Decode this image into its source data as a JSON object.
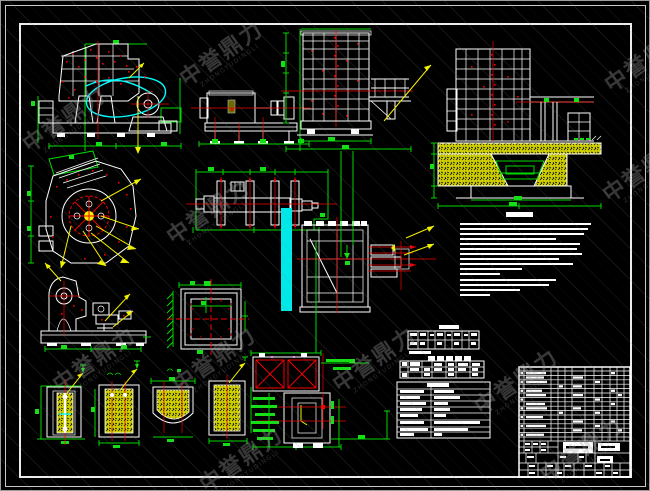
{
  "watermark": {
    "text": "中誉鼎力",
    "subtext": "ZHONGYUDINGLI"
  },
  "colors": {
    "background": "#000000",
    "frame": "#ececec",
    "structure_lines": "#ffffff",
    "dimension_lines": "#00d900",
    "dimension_bright": "#2bff2b",
    "centerlines": "#f40000",
    "leader_lines": "#f2f200",
    "hatch_fill": "#cfcf00",
    "accent_cyan": "#00e8e8",
    "magenta_marks": "#ff00ff",
    "watermark_gray": "#8a8a8a"
  }
}
